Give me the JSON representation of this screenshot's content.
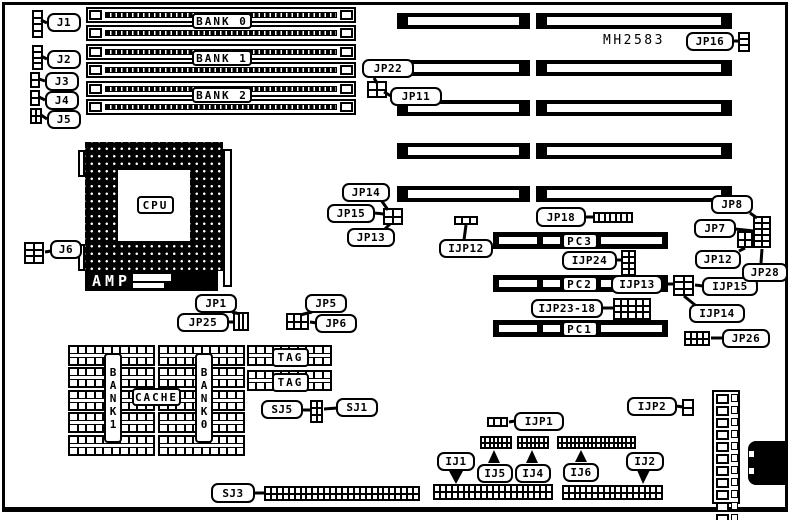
{
  "title": "MH2583 motherboard jumper location diagram",
  "texts": [
    {
      "id": "part-number",
      "text": "MH2583",
      "x": 603,
      "y": 33
    }
  ],
  "colors": {
    "ink": "#000000",
    "paper": "#ffffff"
  },
  "amp": {
    "text": "AMP",
    "x": 85,
    "y": 271,
    "w": 133,
    "h": 20
  },
  "callouts": [
    {
      "id": "j1",
      "text": "J1",
      "x": 47,
      "y": 13,
      "w": 34,
      "h": 19
    },
    {
      "id": "j2",
      "text": "J2",
      "x": 47,
      "y": 50,
      "w": 34,
      "h": 19
    },
    {
      "id": "j3",
      "text": "J3",
      "x": 45,
      "y": 72,
      "w": 34,
      "h": 19
    },
    {
      "id": "j4",
      "text": "J4",
      "x": 45,
      "y": 91,
      "w": 34,
      "h": 19
    },
    {
      "id": "j5",
      "text": "J5",
      "x": 47,
      "y": 110,
      "w": 34,
      "h": 19
    },
    {
      "id": "jp16",
      "text": "JP16",
      "x": 686,
      "y": 32,
      "w": 48,
      "h": 19
    },
    {
      "id": "jp22",
      "text": "JP22",
      "x": 362,
      "y": 59,
      "w": 52,
      "h": 19
    },
    {
      "id": "jp11",
      "text": "JP11",
      "x": 390,
      "y": 87,
      "w": 52,
      "h": 19
    },
    {
      "id": "jp14",
      "text": "JP14",
      "x": 342,
      "y": 183,
      "w": 48,
      "h": 19
    },
    {
      "id": "jp15",
      "text": "JP15",
      "x": 327,
      "y": 204,
      "w": 48,
      "h": 19
    },
    {
      "id": "jp13",
      "text": "JP13",
      "x": 347,
      "y": 228,
      "w": 48,
      "h": 19
    },
    {
      "id": "jp18",
      "text": "JP18",
      "x": 536,
      "y": 207,
      "w": 50,
      "h": 20
    },
    {
      "id": "ijp12",
      "text": "IJP12",
      "x": 439,
      "y": 239,
      "w": 54,
      "h": 19
    },
    {
      "id": "ijp24",
      "text": "IJP24",
      "x": 562,
      "y": 251,
      "w": 55,
      "h": 19
    },
    {
      "id": "ijp13",
      "text": "IJP13",
      "x": 611,
      "y": 275,
      "w": 52,
      "h": 19
    },
    {
      "id": "ijp15",
      "text": "IJP15",
      "x": 702,
      "y": 277,
      "w": 56,
      "h": 19
    },
    {
      "id": "ijp14",
      "text": "IJP14",
      "x": 689,
      "y": 304,
      "w": 56,
      "h": 19
    },
    {
      "id": "ijp2318",
      "text": "IJP23-18",
      "x": 531,
      "y": 299,
      "w": 72,
      "h": 19
    },
    {
      "id": "jp8",
      "text": "JP8",
      "x": 711,
      "y": 195,
      "w": 42,
      "h": 19
    },
    {
      "id": "jp7",
      "text": "JP7",
      "x": 694,
      "y": 219,
      "w": 42,
      "h": 19
    },
    {
      "id": "jp12",
      "text": "JP12",
      "x": 695,
      "y": 250,
      "w": 46,
      "h": 19
    },
    {
      "id": "jp28",
      "text": "JP28",
      "x": 742,
      "y": 263,
      "w": 46,
      "h": 19
    },
    {
      "id": "jp26",
      "text": "JP26",
      "x": 722,
      "y": 329,
      "w": 48,
      "h": 19
    },
    {
      "id": "j6",
      "text": "J6",
      "x": 50,
      "y": 240,
      "w": 32,
      "h": 19
    },
    {
      "id": "jp1",
      "text": "JP1",
      "x": 195,
      "y": 294,
      "w": 42,
      "h": 19
    },
    {
      "id": "jp25",
      "text": "JP25",
      "x": 177,
      "y": 313,
      "w": 52,
      "h": 19
    },
    {
      "id": "jp5",
      "text": "JP5",
      "x": 305,
      "y": 294,
      "w": 42,
      "h": 19
    },
    {
      "id": "jp6",
      "text": "JP6",
      "x": 315,
      "y": 314,
      "w": 42,
      "h": 19
    },
    {
      "id": "sj5",
      "text": "SJ5",
      "x": 261,
      "y": 400,
      "w": 42,
      "h": 19
    },
    {
      "id": "sj1",
      "text": "SJ1",
      "x": 336,
      "y": 398,
      "w": 42,
      "h": 19
    },
    {
      "id": "sj3",
      "text": "SJ3",
      "x": 211,
      "y": 483,
      "w": 44,
      "h": 20
    },
    {
      "id": "ij1",
      "text": "IJ1",
      "x": 437,
      "y": 452,
      "w": 38,
      "h": 19
    },
    {
      "id": "ij5",
      "text": "IJ5",
      "x": 477,
      "y": 464,
      "w": 36,
      "h": 19
    },
    {
      "id": "ij4",
      "text": "IJ4",
      "x": 515,
      "y": 464,
      "w": 36,
      "h": 19
    },
    {
      "id": "ij6",
      "text": "IJ6",
      "x": 563,
      "y": 463,
      "w": 36,
      "h": 19
    },
    {
      "id": "ij2",
      "text": "IJ2",
      "x": 626,
      "y": 452,
      "w": 38,
      "h": 19
    },
    {
      "id": "ijp1",
      "text": "IJP1",
      "x": 514,
      "y": 412,
      "w": 50,
      "h": 19
    },
    {
      "id": "ijp2",
      "text": "IJP2",
      "x": 627,
      "y": 397,
      "w": 50,
      "h": 19
    }
  ],
  "box_labels": [
    {
      "id": "bank0",
      "text": "BANK 0",
      "x": 192,
      "y": 13,
      "w": 60,
      "h": 16
    },
    {
      "id": "bank1",
      "text": "BANK 1",
      "x": 192,
      "y": 50,
      "w": 60,
      "h": 16
    },
    {
      "id": "bank2",
      "text": "BANK 2",
      "x": 192,
      "y": 87,
      "w": 60,
      "h": 16
    },
    {
      "id": "cpu",
      "text": "CPU",
      "x": 137,
      "y": 196,
      "w": 37,
      "h": 18
    },
    {
      "id": "pc3",
      "text": "PC3",
      "x": 562,
      "y": 233,
      "w": 36,
      "h": 16
    },
    {
      "id": "pc2",
      "text": "PC2",
      "x": 562,
      "y": 276,
      "w": 36,
      "h": 16
    },
    {
      "id": "pc1",
      "text": "PC1",
      "x": 562,
      "y": 321,
      "w": 36,
      "h": 16
    },
    {
      "id": "tag-1",
      "text": "TAG",
      "x": 272,
      "y": 348,
      "w": 37,
      "h": 19
    },
    {
      "id": "tag-2",
      "text": "TAG",
      "x": 272,
      "y": 373,
      "w": 37,
      "h": 19
    },
    {
      "id": "cache",
      "text": "CACHE",
      "x": 132,
      "y": 388,
      "w": 49,
      "h": 18
    },
    {
      "id": "bank1-v",
      "text": "BANK1",
      "x": 104,
      "y": 353,
      "w": 18,
      "h": 90,
      "vertical": true
    },
    {
      "id": "bank0-v",
      "text": "BANK0",
      "x": 195,
      "y": 353,
      "w": 18,
      "h": 90,
      "vertical": true
    }
  ],
  "simm_slots": [
    {
      "x": 86,
      "y": 7,
      "w": 270,
      "h": 16
    },
    {
      "x": 86,
      "y": 25,
      "w": 270,
      "h": 16
    },
    {
      "x": 86,
      "y": 44,
      "w": 270,
      "h": 16
    },
    {
      "x": 86,
      "y": 62,
      "w": 270,
      "h": 16
    },
    {
      "x": 86,
      "y": 81,
      "w": 270,
      "h": 16
    },
    {
      "x": 86,
      "y": 99,
      "w": 270,
      "h": 16
    }
  ],
  "expansion_slots": [
    {
      "x": 397,
      "y": 13,
      "w": 133,
      "h": 16
    },
    {
      "x": 536,
      "y": 13,
      "w": 196,
      "h": 16
    },
    {
      "x": 397,
      "y": 60,
      "w": 133,
      "h": 16
    },
    {
      "x": 536,
      "y": 60,
      "w": 196,
      "h": 16
    },
    {
      "x": 397,
      "y": 100,
      "w": 133,
      "h": 16
    },
    {
      "x": 536,
      "y": 100,
      "w": 196,
      "h": 16
    },
    {
      "x": 397,
      "y": 143,
      "w": 133,
      "h": 16
    },
    {
      "x": 536,
      "y": 143,
      "w": 196,
      "h": 16
    },
    {
      "x": 397,
      "y": 186,
      "w": 133,
      "h": 16
    },
    {
      "x": 536,
      "y": 186,
      "w": 196,
      "h": 16
    }
  ],
  "pc_slots": [
    {
      "id": "pc3",
      "x": 493,
      "y": 232,
      "w": 175,
      "h": 17
    },
    {
      "id": "pc2",
      "x": 493,
      "y": 275,
      "w": 175,
      "h": 17
    },
    {
      "id": "pc1",
      "x": 493,
      "y": 320,
      "w": 175,
      "h": 17
    }
  ],
  "pin_grids": [
    {
      "id": "j1",
      "x": 32,
      "y": 10,
      "w": 11,
      "h": 28,
      "rows": 4,
      "cols": 1
    },
    {
      "id": "j2",
      "x": 32,
      "y": 45,
      "w": 11,
      "h": 25,
      "rows": 4,
      "cols": 1
    },
    {
      "id": "j3",
      "x": 30,
      "y": 72,
      "w": 10,
      "h": 16,
      "rows": 2,
      "cols": 1
    },
    {
      "id": "j4",
      "x": 30,
      "y": 90,
      "w": 10,
      "h": 16,
      "rows": 2,
      "cols": 1
    },
    {
      "id": "j5",
      "x": 30,
      "y": 108,
      "w": 12,
      "h": 16,
      "rows": 2,
      "cols": 2
    },
    {
      "id": "jp16",
      "x": 738,
      "y": 32,
      "w": 12,
      "h": 20,
      "rows": 3,
      "cols": 1
    },
    {
      "id": "jp22-11",
      "x": 367,
      "y": 81,
      "w": 20,
      "h": 17,
      "rows": 2,
      "cols": 2
    },
    {
      "id": "jp14-15",
      "x": 383,
      "y": 208,
      "w": 20,
      "h": 17,
      "rows": 2,
      "cols": 2
    },
    {
      "id": "ijp12",
      "x": 454,
      "y": 216,
      "w": 24,
      "h": 9,
      "rows": 1,
      "cols": 3
    },
    {
      "id": "jp18",
      "x": 593,
      "y": 212,
      "w": 40,
      "h": 11,
      "rows": 1,
      "cols": 7
    },
    {
      "id": "ijp24",
      "x": 621,
      "y": 250,
      "w": 15,
      "h": 26,
      "rows": 4,
      "cols": 2
    },
    {
      "id": "ijp13",
      "x": 673,
      "y": 275,
      "w": 21,
      "h": 21,
      "rows": 3,
      "cols": 2
    },
    {
      "id": "jp7-8",
      "x": 753,
      "y": 216,
      "w": 18,
      "h": 32,
      "rows": 5,
      "cols": 2
    },
    {
      "id": "jp7-8b",
      "x": 737,
      "y": 231,
      "w": 16,
      "h": 17,
      "rows": 2,
      "cols": 2
    },
    {
      "id": "ijp23-18",
      "x": 613,
      "y": 298,
      "w": 38,
      "h": 22,
      "rows": 3,
      "cols": 5
    },
    {
      "id": "jp26",
      "x": 684,
      "y": 331,
      "w": 26,
      "h": 15,
      "rows": 2,
      "cols": 4
    },
    {
      "id": "j6",
      "x": 24,
      "y": 242,
      "w": 20,
      "h": 22,
      "rows": 3,
      "cols": 2
    },
    {
      "id": "jp25",
      "x": 233,
      "y": 312,
      "w": 16,
      "h": 19,
      "rows": 1,
      "cols": 3
    },
    {
      "id": "jp5-6",
      "x": 286,
      "y": 313,
      "w": 23,
      "h": 17,
      "rows": 2,
      "cols": 3
    },
    {
      "id": "sj5-1",
      "x": 310,
      "y": 400,
      "w": 13,
      "h": 23,
      "rows": 3,
      "cols": 2
    },
    {
      "id": "ijp1",
      "x": 487,
      "y": 417,
      "w": 21,
      "h": 10,
      "rows": 1,
      "cols": 3
    },
    {
      "id": "ijp2",
      "x": 682,
      "y": 399,
      "w": 12,
      "h": 17,
      "rows": 2,
      "cols": 1
    },
    {
      "id": "ij5",
      "x": 480,
      "y": 436,
      "w": 32,
      "h": 13,
      "rows": 2,
      "cols": 7
    },
    {
      "id": "ij4",
      "x": 517,
      "y": 436,
      "w": 32,
      "h": 13,
      "rows": 2,
      "cols": 7
    },
    {
      "id": "ij6",
      "x": 557,
      "y": 436,
      "w": 79,
      "h": 13,
      "rows": 2,
      "cols": 18
    },
    {
      "id": "sj3",
      "x": 264,
      "y": 486,
      "w": 156,
      "h": 15,
      "rows": 2,
      "cols": 26
    },
    {
      "id": "ij1",
      "x": 433,
      "y": 484,
      "w": 120,
      "h": 16,
      "rows": 2,
      "cols": 20
    },
    {
      "id": "ij2",
      "x": 562,
      "y": 485,
      "w": 101,
      "h": 15,
      "rows": 2,
      "cols": 17
    }
  ],
  "cache_rows": [
    {
      "x": 68,
      "y": 345,
      "w": 87,
      "h": 21
    },
    {
      "x": 68,
      "y": 367,
      "w": 87,
      "h": 21
    },
    {
      "x": 68,
      "y": 390,
      "w": 87,
      "h": 21
    },
    {
      "x": 68,
      "y": 412,
      "w": 87,
      "h": 21
    },
    {
      "x": 68,
      "y": 435,
      "w": 87,
      "h": 21
    },
    {
      "x": 158,
      "y": 345,
      "w": 87,
      "h": 21
    },
    {
      "x": 158,
      "y": 367,
      "w": 87,
      "h": 21
    },
    {
      "x": 158,
      "y": 390,
      "w": 87,
      "h": 21
    },
    {
      "x": 158,
      "y": 412,
      "w": 87,
      "h": 21
    },
    {
      "x": 158,
      "y": 435,
      "w": 87,
      "h": 21
    },
    {
      "x": 247,
      "y": 345,
      "w": 85,
      "h": 21
    },
    {
      "x": 247,
      "y": 370,
      "w": 85,
      "h": 21
    }
  ],
  "cpu": {
    "socket": {
      "x": 85,
      "y": 142,
      "w": 138,
      "h": 129
    },
    "inner": {
      "x": 118,
      "y": 170,
      "w": 72,
      "h": 71
    },
    "lever": {
      "x": 223,
      "y": 149,
      "w": 9,
      "h": 138
    },
    "tabs": [
      {
        "x": 78,
        "y": 150,
        "w": 7,
        "h": 27
      },
      {
        "x": 78,
        "y": 244,
        "w": 7,
        "h": 27
      }
    ]
  },
  "power_connector": {
    "x": 712,
    "y": 390,
    "w": 28,
    "h": 114,
    "pins": 12
  },
  "din_connector": {
    "x": 748,
    "y": 441,
    "w": 40,
    "h": 44
  },
  "leaders": [
    [
      47,
      23,
      41,
      20
    ],
    [
      47,
      59,
      41,
      56
    ],
    [
      45,
      81,
      39,
      79
    ],
    [
      45,
      100,
      39,
      97
    ],
    [
      47,
      119,
      41,
      115
    ],
    [
      733,
      41,
      739,
      41
    ],
    [
      374,
      78,
      377,
      83
    ],
    [
      391,
      96,
      384,
      92
    ],
    [
      381,
      200,
      388,
      210
    ],
    [
      374,
      213,
      384,
      214
    ],
    [
      385,
      229,
      390,
      224
    ],
    [
      585,
      217,
      593,
      217
    ],
    [
      464,
      240,
      466,
      225
    ],
    [
      616,
      260,
      622,
      260
    ],
    [
      662,
      284,
      674,
      284
    ],
    [
      703,
      286,
      695,
      285
    ],
    [
      695,
      305,
      684,
      296
    ],
    [
      602,
      308,
      614,
      308
    ],
    [
      750,
      213,
      757,
      218
    ],
    [
      735,
      229,
      754,
      231
    ],
    [
      739,
      251,
      745,
      248
    ],
    [
      761,
      263,
      762,
      249
    ],
    [
      723,
      338,
      711,
      338
    ],
    [
      51,
      251,
      45,
      252
    ],
    [
      232,
      312,
      240,
      314
    ],
    [
      228,
      322,
      234,
      322
    ],
    [
      312,
      312,
      300,
      315
    ],
    [
      317,
      323,
      310,
      322
    ],
    [
      302,
      410,
      311,
      410
    ],
    [
      337,
      408,
      324,
      409
    ],
    [
      254,
      493,
      265,
      493
    ],
    [
      515,
      421,
      509,
      422
    ],
    [
      676,
      406,
      683,
      407
    ]
  ],
  "arrows": [
    {
      "id": "ij1",
      "points": "449,471 463,471 456,484"
    },
    {
      "id": "ij2",
      "points": "637,470 650,470 643,484"
    },
    {
      "id": "ij5",
      "points": "488,463 500,463 494,450"
    },
    {
      "id": "ij4",
      "points": "526,463 538,463 532,450"
    },
    {
      "id": "ij6",
      "points": "575,462 587,462 581,450"
    }
  ]
}
